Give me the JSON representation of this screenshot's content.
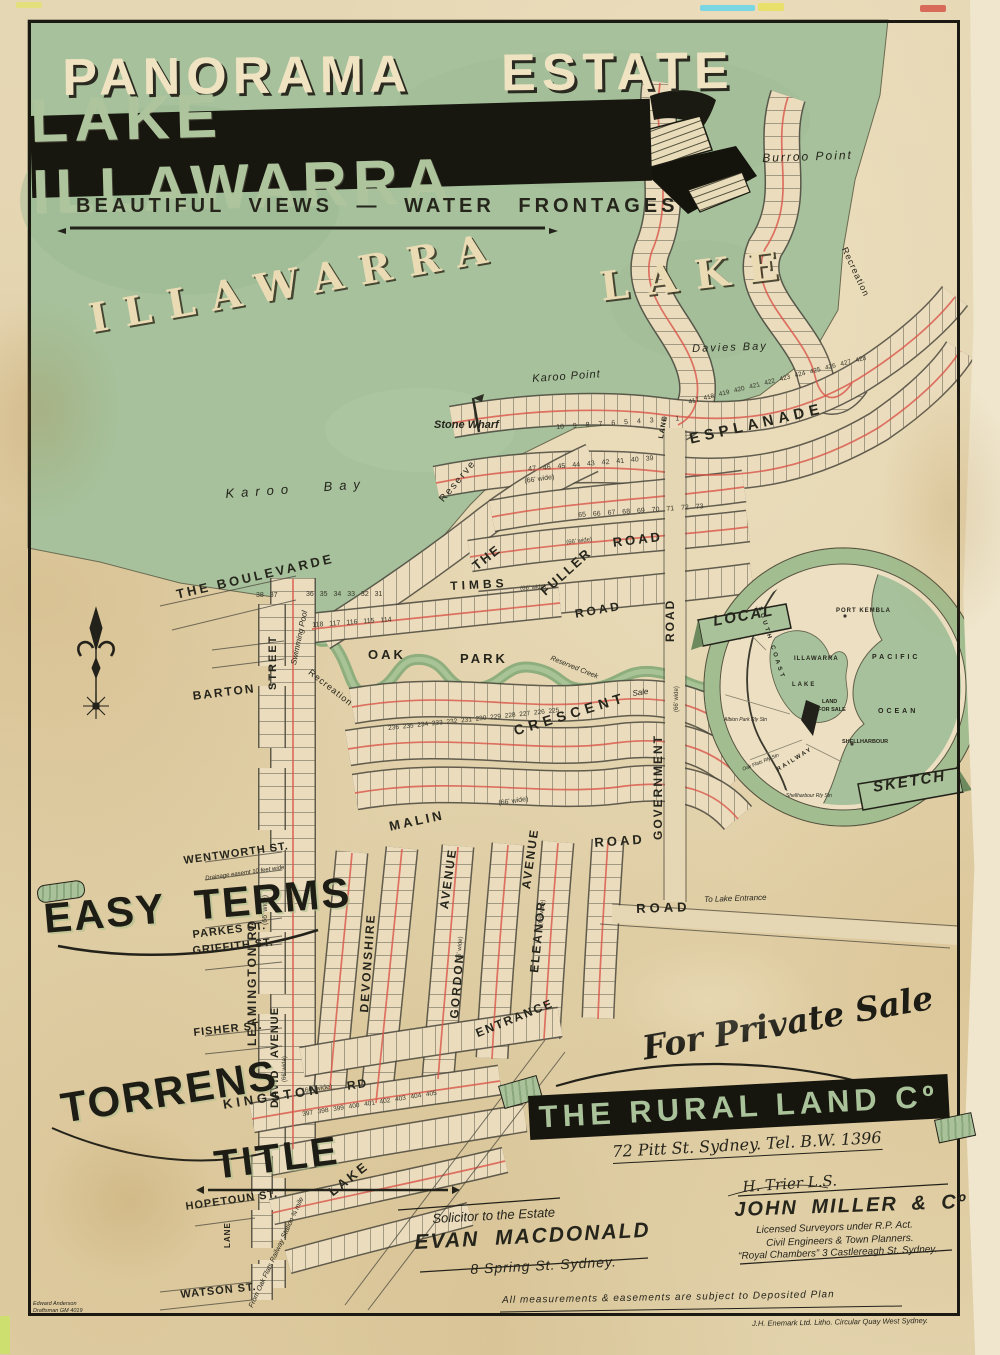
{
  "poster": {
    "title_line1": "PANORAMA ESTATE",
    "title_line2": "LAKE ILLAWARRA",
    "subtitle": "BEAUTIFUL VIEWS — WATER FRONTAGES"
  },
  "water": {
    "illawarra": "ILLAWARRA",
    "lake": "LAKE",
    "davies_bay": "Davies Bay",
    "burroo_point": "Burroo Point",
    "karoo_point": "Karoo Point",
    "karoo_bay": "Karoo Bay",
    "stone_wharf": "Stone Wharf",
    "reserve": "Reserve",
    "recreation": "Recreation",
    "recreation2": "Recreation",
    "swimming_pool": "Swimming Pool",
    "reserved_creek": "Reserved Creek",
    "sale": "Sale"
  },
  "streets": {
    "the_boulevarde": "THE BOULEVARDE",
    "street_word": "STREET",
    "barton": "BARTON",
    "leamington_rd": "LEAMINGTON RD",
    "parkes": "PARKES ST.",
    "wentworth": "WENTWORTH ST.",
    "drainage_easement": "Drainage easemt 10 feet wide",
    "griffith": "GRIFFITH ST.",
    "fisher": "FISHER ST.",
    "hopetoun": "HOPETOUN ST.",
    "watson": "WATSON ST.",
    "kingston": "KINGSTON",
    "rd_abbrev": "RD",
    "david": "DAVID",
    "avenue_word": "AVENUE",
    "devonshire": "DEVONSHIRE",
    "gordon": "GORDON",
    "eleanor": "ELEANOR",
    "entrance": "ENTRANCE",
    "malin": "MALIN",
    "road_word": "ROAD",
    "crescent": "CRESCENT",
    "the_word": "THE",
    "esplanade": "ESPLANADE",
    "fuller": "FULLER",
    "timbs": "TIMBS",
    "oak": "OAK",
    "park": "PARK",
    "government": "GOVERNMENT",
    "lake_road": "LAKE",
    "lane": "LANE",
    "to_lake_entrance": "To Lake Entrance",
    "from_oak_flats": "From Oak Flats Railway Station ¾ mile",
    "width_66": "(66' wide)"
  },
  "inset": {
    "local": "LOCAL",
    "sketch": "SKETCH",
    "port_kembla": "PORT KEMBLA",
    "illawarra": "ILLAWARRA",
    "lake": "LAKE",
    "pacific": "PACIFIC",
    "ocean": "OCEAN",
    "land": "LAND",
    "for_sale": "FOR SALE",
    "shellharbour": "SHELLHARBOUR",
    "south_coast": "SOUTH COAST",
    "railway": "RAILWAY",
    "albion_station": "Albion Park Rly Stn",
    "oak_flats_station": "Oak Flats Rly Stn",
    "shellharbour_station": "Shellharbour Rly Stn"
  },
  "promo": {
    "easy_terms": "EASY TERMS",
    "torrens": "TORRENS",
    "title_word": "TITLE",
    "for_private_sale": "For Private Sale",
    "by": "by",
    "company": "THE RURAL LAND Cº",
    "company_address": "72 Pitt St. Sydney.   Tel. B.W. 1396"
  },
  "credits": {
    "solicitor_label": "Solicitor to the Estate",
    "solicitor_name": "EVAN MACDONALD",
    "solicitor_address": "8 Spring St. Sydney.",
    "signature": "H. Trier  L.S.",
    "surveyor_name": "JOHN MILLER & Cº",
    "surveyor_line1": "Licensed Surveyors under R.P. Act.",
    "surveyor_line2": "Civil Engineers & Town Planners.",
    "surveyor_line3": "“Royal Chambers”  3 Castlereagh St. Sydney.",
    "measurements_note": "All measurements & easements are subject to Deposited Plan",
    "litho_credit": "J.H. Enemark Ltd. Litho. Circular Quay West Sydney.",
    "draftsman_line1": "Edward Anderson",
    "draftsman_line2": "Draftsman GM 4019"
  },
  "lots": {
    "esplanade_row_a": "10 9 8 7 6 5 4 3 2 1",
    "esplanade_row_b": "417 418 419 420 421 422 423 424 425 426 427 428",
    "reserve_row": "47 46 45 44 43 42 41 40 39",
    "fuller_row": "65 66 67 68 69 70 71 72 73",
    "timbs_row": "118 117 116 115 114",
    "boulevarde_row": "38 37",
    "boulevarde_row_b": "36 35 34 33 32 31",
    "crescent_row": "236 235 234 233 232 231 230 229 228 227 226 225",
    "kingston_row": "397 398 399 400 401 402 403 404 405"
  },
  "colors": {
    "paper": "#e5d6b2",
    "lake_green": "#a6c19b",
    "banner_black": "#17160f",
    "letter_green": "#adc49c",
    "ink": "#26251c",
    "lot_red": "#d95548"
  }
}
